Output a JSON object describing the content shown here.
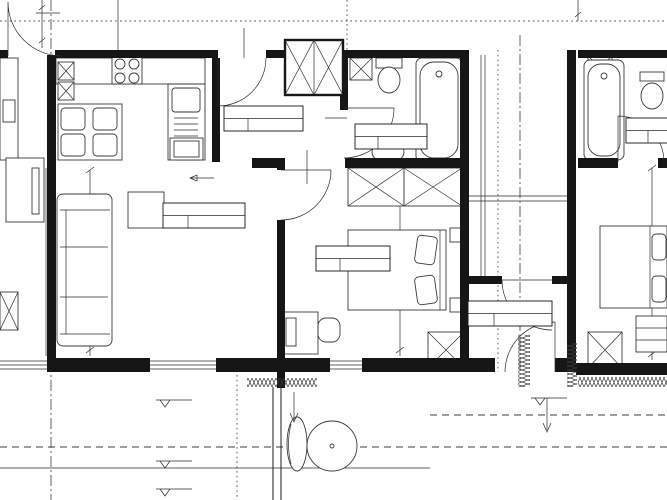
{
  "watermark": "KONTRAKT",
  "plan": {
    "apartment_name": "MIESZKANIE 4",
    "edge_text": "0mm"
  },
  "rooms": {
    "przedpokoj": {
      "block": "KLATKA A",
      "name": "PRZEDPOKÓJ",
      "no": "1/16",
      "area": "4,71"
    },
    "lazienka": {
      "block": "KLATKA A",
      "name": "ŁAZIENKA",
      "no": "1/17",
      "area": "3,87"
    },
    "pokoj": {
      "block": "KLATKA A",
      "name": "POKÓJ",
      "no": "1/18",
      "area": "11,48"
    },
    "pokoj_aneks": {
      "block": "KLATKA A",
      "name": "POKÓJ+ANEKS K.",
      "no": "1/19",
      "area": "20,23"
    },
    "wiatrolap": {
      "block": "KLATKA A",
      "name": "WIATROŁAP",
      "no": "1/1",
      "area": "3,94"
    },
    "lazienka_2": {
      "block": "KLATKA A",
      "name": "ŁAZIENKA",
      "no": "1/5",
      "area": "3,9"
    }
  },
  "dims": {
    "d14": "14",
    "d26": "26",
    "d80": "80",
    "d90": "90",
    "d100": "100",
    "d116": "116",
    "d149": "149",
    "d161": "161",
    "d178": "178",
    "d198": "198",
    "d200": "200",
    "d220": "220",
    "d238": "238",
    "d240": "240",
    "d269": "269",
    "d323": "323",
    "d362": "362",
    "d460": "460",
    "d574": "574"
  },
  "levels": {
    "a": "-0,02",
    "b": "-0,03",
    "c": "-0,10",
    "slope": "1%"
  }
}
